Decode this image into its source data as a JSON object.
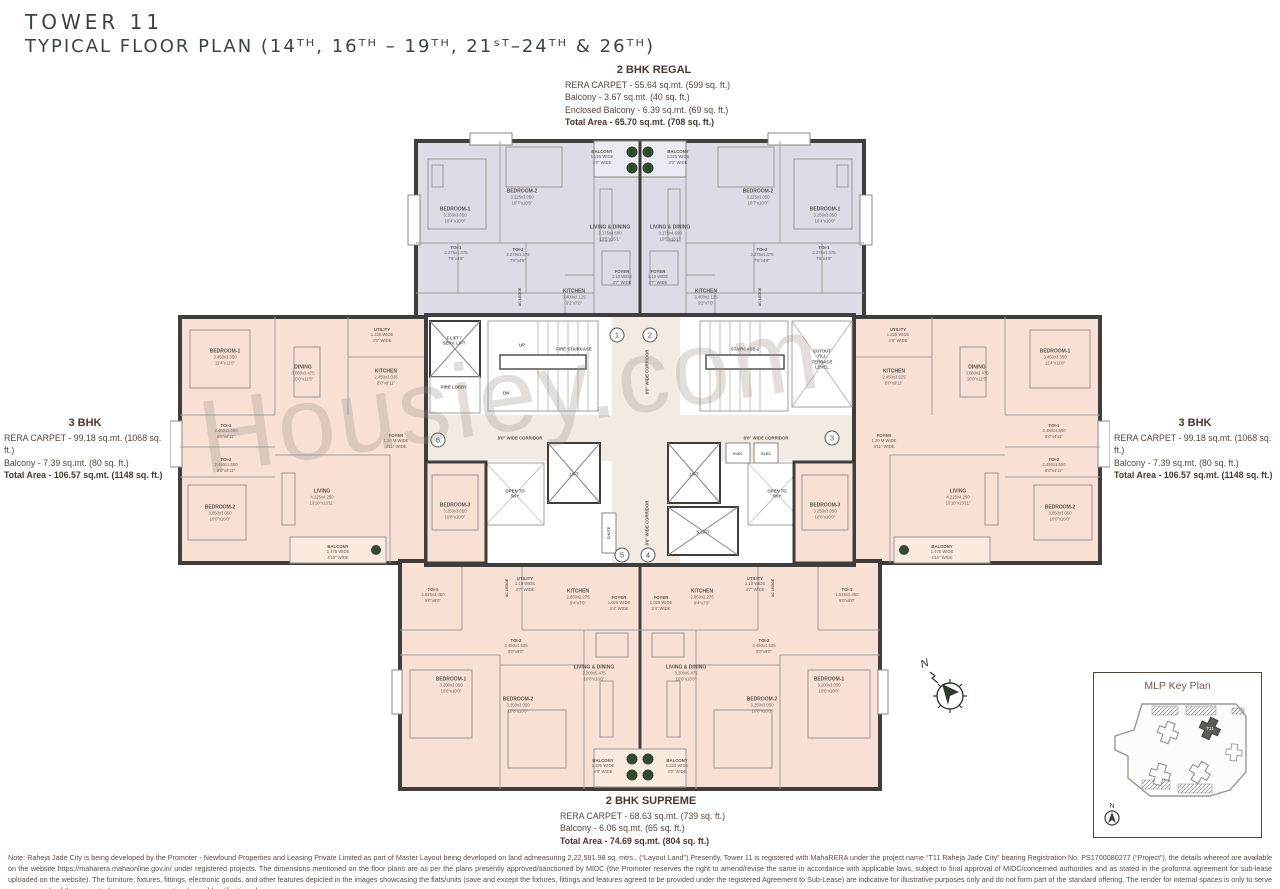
{
  "page": {
    "title_line1": "TOWER 11",
    "title_line2": "TYPICAL FLOOR PLAN (14ᵀᴴ, 16ᵀᴴ – 19ᵀᴴ, 21ˢᵀ–24ᵀᴴ & 26ᵀᴴ)"
  },
  "units": {
    "regal": {
      "name": "2 BHK REGAL",
      "line1": "RERA CARPET - 55.64 sq.mt. (599 sq. ft.)",
      "line2": "Balcony  - 3.67 sq.mt. (40 sq. ft.)",
      "line3": "Enclosed Balcony  - 6.39 sq.mt. (69 sq. ft.)",
      "total": "Total Area - 65.70 sq.mt. (708 sq. ft.)"
    },
    "bhk3_left": {
      "name": "3 BHK",
      "line1": "RERA CARPET - 99.18 sq.mt. (1068 sq. ft.)",
      "line2": "Balcony  - 7.39 sq.mt. (80 sq. ft.)",
      "total": "Total Area - 106.57 sq.mt. (1148 sq. ft.)"
    },
    "bhk3_right": {
      "name": "3 BHK",
      "line1": "RERA CARPET - 99.18 sq.mt. (1068 sq. ft.)",
      "line2": "Balcony  - 7.39 sq.mt. (80 sq. ft.)",
      "total": "Total Area - 106.57 sq.mt. (1148 sq. ft.)"
    },
    "supreme": {
      "name": "2 BHK SUPREME",
      "line1": "RERA CARPET - 68.63 sq.mt. (739 sq. ft.)",
      "line2": "Balcony  - 6.06 sq.mt. (65 sq. ft.)",
      "total": "Total Area - 74.69 sq.mt. (804 sq. ft.)"
    }
  },
  "watermark": "Housiey.com",
  "compass_label": "N",
  "key_plan": {
    "title": "MLP Key Plan",
    "highlight_tower": "T11",
    "compass": "N"
  },
  "note": "Note: Raheja Jade City is being developed by the Promoter - Newfound Properties and Leasing Private Limited as part of Master Layout being developed on land admeasuring 2,22,591.98 sq. mtrs.. (“Layout Land”) Presently, Tower 11 is registered with MahaRERA under the project name “T11 Raheja Jade City” bearing Registration No. PS1700080277 (“Project”), the details whereof are available on the website https://maharera.mahaonline.gov.in/ under registered projects. The dimensions mentioned on the floor plans are as per the plans presently approved/sanctioned by MIDC (the Promoter reserves the right to amend/revise the same in accordance with applicable laws, subject to final approval of MIDC/concerned authorities and as stated in the proforma agreement for sub-lease uploaded on the website). The furniture, fixtures, fittings, electronic goods, and other features depicted in the images showcasing the flats/units (save and except the fixtures, fittings and features agreed to be provided under the registered Agreement to Sub-Lease) are indicative for illustrative purposes only and do not form part of the standard offering. The render for internal spaces is only to serve as an example of the suggested space management and possible utilization of space.",
  "colors": {
    "wall": "#403e3b",
    "regal_fill": "#dcdbe6",
    "bhk_fill": "#f9e0d5",
    "corridor_fill": "#f2ebe4",
    "plant_green": "#2f4a2f",
    "heading_text": "#4a382e",
    "title_text": "#3c443e"
  },
  "floor_plan": {
    "circled_numbers": [
      {
        "n": "1",
        "x": 447,
        "y": 210
      },
      {
        "n": "2",
        "x": 480,
        "y": 210
      },
      {
        "n": "3",
        "x": 662,
        "y": 313
      },
      {
        "n": "4",
        "x": 478,
        "y": 430
      },
      {
        "n": "5",
        "x": 452,
        "y": 430
      },
      {
        "n": "6",
        "x": 268,
        "y": 315
      }
    ],
    "labels": [
      {
        "t": "BALCONY",
        "d": "1.225 WIDE\n4'0\" WIDE",
        "x": 432,
        "y": 32,
        "s": "xs"
      },
      {
        "t": "BALCONY",
        "d": "1.225 WIDE\n4'0\" WIDE",
        "x": 508,
        "y": 32,
        "s": "xs"
      },
      {
        "t": "BEDROOM-1",
        "d": "3.150x3.050\n10'4\"x10'0\"",
        "x": 285,
        "y": 90
      },
      {
        "t": "BEDROOM-2",
        "d": "3.225x3.050\n10'7\"x10'0\"",
        "x": 352,
        "y": 72
      },
      {
        "t": "LIVING & DINING",
        "d": "3.175x4.600\n10'5\"x15'1\"",
        "x": 440,
        "y": 108
      },
      {
        "t": "TOI-1",
        "d": "2.275x1.375\n7'6\"x4'6\"",
        "x": 286,
        "y": 128,
        "s": "xs"
      },
      {
        "t": "TOI-2",
        "d": "2.275x1.375\n7'6\"x4'6\"",
        "x": 348,
        "y": 130,
        "s": "xs"
      },
      {
        "t": "KITCHEN",
        "d": "3.400x2.125\n9'2\"x7'0\"",
        "x": 404,
        "y": 172
      },
      {
        "t": "FOYER",
        "d": "1.10 WIDE\n3'7\" WIDE",
        "x": 452,
        "y": 152,
        "s": "xs"
      },
      {
        "t": "AC LEDGE",
        "x": 350,
        "y": 172,
        "r": -90,
        "s": "xxs"
      },
      {
        "t": "BEDROOM-1",
        "d": "3.150x3.050\n10'4\"x10'0\"",
        "x": 655,
        "y": 90
      },
      {
        "t": "BEDROOM-2",
        "d": "3.225x3.050\n10'7\"x10'0\"",
        "x": 588,
        "y": 72
      },
      {
        "t": "LIVING & DINING",
        "d": "3.175x4.600\n10'5\"x15'1\"",
        "x": 500,
        "y": 108
      },
      {
        "t": "TOI-1",
        "d": "2.275x1.375\n7'6\"x4'6\"",
        "x": 654,
        "y": 128,
        "s": "xs"
      },
      {
        "t": "TOI-2",
        "d": "2.275x1.375\n7'6\"x4'6\"",
        "x": 592,
        "y": 130,
        "s": "xs"
      },
      {
        "t": "KITCHEN",
        "d": "3.400x2.125\n9'2\"x7'0\"",
        "x": 536,
        "y": 172
      },
      {
        "t": "FOYER",
        "d": "1.10 WIDE\n3'7\" WIDE",
        "x": 488,
        "y": 152,
        "s": "xs"
      },
      {
        "t": "AC LEDGE",
        "x": 590,
        "y": 172,
        "r": -90,
        "s": "xxs"
      },
      {
        "t": "F.LIFT /\nSERV. LIFT",
        "x": 284,
        "y": 216,
        "s": "xs"
      },
      {
        "t": "FIRE LOBBY",
        "x": 284,
        "y": 262,
        "s": "xs"
      },
      {
        "t": "UP",
        "x": 352,
        "y": 220,
        "s": "xs"
      },
      {
        "t": "DN",
        "x": 336,
        "y": 268,
        "s": "xs"
      },
      {
        "t": "FIRE STAIRCASE",
        "x": 404,
        "y": 224,
        "s": "xs"
      },
      {
        "t": "STAIRCASE-2",
        "x": 575,
        "y": 224,
        "s": "xs"
      },
      {
        "t": "CUTOUT\nTILL\nTERRACE\nLEVEL",
        "x": 652,
        "y": 234,
        "s": "xs"
      },
      {
        "t": "LIFT",
        "x": 404,
        "y": 349,
        "s": "xs"
      },
      {
        "t": "LIFT",
        "x": 524,
        "y": 349,
        "s": "xs"
      },
      {
        "t": "S.LIFT",
        "x": 533,
        "y": 407,
        "s": "xs"
      },
      {
        "t": "OPEN TO\nSKY",
        "x": 345,
        "y": 369,
        "s": "xs"
      },
      {
        "t": "OPEN TO\nSKY",
        "x": 607,
        "y": 369,
        "s": "xs"
      },
      {
        "t": "ELEC",
        "x": 568,
        "y": 329,
        "s": "xxs"
      },
      {
        "t": "ELEC",
        "x": 596,
        "y": 329,
        "s": "xxs"
      },
      {
        "t": "CHUTE",
        "x": 439,
        "y": 408,
        "r": -90,
        "s": "xxs"
      },
      {
        "t": "8'0\" WIDE CORRIDOR",
        "x": 477,
        "y": 247,
        "r": -90,
        "s": "xs"
      },
      {
        "t": "8'0\" WIDE CORRIDOR",
        "x": 477,
        "y": 398,
        "r": -90,
        "s": "xs"
      },
      {
        "t": "8'0\" WIDE CORRIDOR",
        "x": 350,
        "y": 313,
        "s": "xs"
      },
      {
        "t": "8'0\" WIDE CORRIDOR",
        "x": 596,
        "y": 313,
        "s": "xs"
      },
      {
        "t": "BEDROOM-1",
        "d": "3.450x3.350\n11'4\"x11'0\"",
        "x": 55,
        "y": 232
      },
      {
        "t": "DINING",
        "d": "3.060x3.475\n10'0\"x11'5\"",
        "x": 133,
        "y": 248
      },
      {
        "t": "KITCHEN",
        "d": "2.450x3.025\n8'0\"x9'11\"",
        "x": 216,
        "y": 252
      },
      {
        "t": "UTILITY",
        "d": "1.225 WIDE\n4'0\" WIDE",
        "x": 212,
        "y": 210,
        "s": "xs"
      },
      {
        "t": "TOI-1",
        "d": "2.450x1.500\n8'0\"x4'11\"",
        "x": 56,
        "y": 306,
        "s": "xs"
      },
      {
        "t": "TOI-2",
        "d": "2.450x1.500\n8'0\"x4'11\"",
        "x": 56,
        "y": 340,
        "s": "xs"
      },
      {
        "t": "BEDROOM-2",
        "d": "3.050x3.050\n10'0\"x10'0\"",
        "x": 50,
        "y": 388
      },
      {
        "t": "LIVING",
        "d": "4.225x4.250\n13'10\"x13'11\"",
        "x": 152,
        "y": 372
      },
      {
        "t": "FOYER",
        "d": "1.20 M WIDE\n3'11\" WIDE",
        "x": 226,
        "y": 316,
        "s": "xs"
      },
      {
        "t": "BEDROOM-3",
        "d": "3.250x3.050\n10'8\"x10'0\"",
        "x": 285,
        "y": 386
      },
      {
        "t": "BALCONY",
        "d": "1.475 WIDE\n4'10\" WIDE",
        "x": 168,
        "y": 427,
        "s": "xs"
      },
      {
        "t": "BEDROOM-1",
        "d": "3.450x3.350\n11'4\"x11'0\"",
        "x": 885,
        "y": 232
      },
      {
        "t": "DINING",
        "d": "3.060x3.475\n10'0\"x11'5\"",
        "x": 807,
        "y": 248
      },
      {
        "t": "KITCHEN",
        "d": "2.450x3.025\n8'0\"x9'11\"",
        "x": 724,
        "y": 252
      },
      {
        "t": "UTILITY",
        "d": "1.225 WIDE\n4'0\" WIDE",
        "x": 728,
        "y": 210,
        "s": "xs"
      },
      {
        "t": "TOI-1",
        "d": "2.450x1.500\n8'0\"x4'11\"",
        "x": 884,
        "y": 306,
        "s": "xs"
      },
      {
        "t": "TOI-2",
        "d": "2.450x1.500\n8'0\"x4'11\"",
        "x": 884,
        "y": 340,
        "s": "xs"
      },
      {
        "t": "BEDROOM-2",
        "d": "3.050x3.050\n10'0\"x10'0\"",
        "x": 890,
        "y": 388
      },
      {
        "t": "LIVING",
        "d": "4.225x4.250\n13'10\"x13'11\"",
        "x": 788,
        "y": 372
      },
      {
        "t": "FOYER",
        "d": "1.20 M WIDE\n3'11\" WIDE",
        "x": 714,
        "y": 316,
        "s": "xs"
      },
      {
        "t": "BEDROOM-3",
        "d": "3.250x3.050\n10'8\"x10'0\"",
        "x": 655,
        "y": 386
      },
      {
        "t": "BALCONY",
        "d": "1.475 WIDE\n4'10\" WIDE",
        "x": 772,
        "y": 427,
        "s": "xs"
      },
      {
        "t": "UTILITY",
        "d": "1.10 WIDE\n3'7\" WIDE",
        "x": 355,
        "y": 459,
        "s": "xs"
      },
      {
        "t": "KITCHEN",
        "d": "2.850x2.275\n9'4\"x7'5\"",
        "x": 408,
        "y": 472
      },
      {
        "t": "FOYER",
        "d": "1.025 WIDE\n3'4\" WIDE",
        "x": 449,
        "y": 478,
        "s": "xs"
      },
      {
        "t": "TOI-1",
        "d": "1.525x2.450\n5'0\"x8'0\"",
        "x": 263,
        "y": 470,
        "s": "xs"
      },
      {
        "t": "TOI-2",
        "d": "2.450x1.525\n8'0\"x5'0\"",
        "x": 346,
        "y": 521,
        "s": "xs"
      },
      {
        "t": "BEDROOM-1",
        "d": "3.200x3.050\n10'6\"x10'0\"",
        "x": 281,
        "y": 560
      },
      {
        "t": "BEDROOM-2",
        "d": "3.250x3.050\n10'8\"x10'0\"",
        "x": 348,
        "y": 580
      },
      {
        "t": "LIVING & DINING",
        "d": "3.200x5.475\n10'6\"x18'0\"",
        "x": 424,
        "y": 548
      },
      {
        "t": "BALCONY",
        "d": "1.225 WIDE\n4'0\" WIDE",
        "x": 433,
        "y": 641,
        "s": "xs"
      },
      {
        "t": "AC LEDGE",
        "x": 337,
        "y": 463,
        "r": -90,
        "s": "xxs"
      },
      {
        "t": "UTILITY",
        "d": "1.10 WIDE\n3'7\" WIDE",
        "x": 585,
        "y": 459,
        "s": "xs"
      },
      {
        "t": "KITCHEN",
        "d": "2.850x2.275\n9'4\"x7'5\"",
        "x": 532,
        "y": 472
      },
      {
        "t": "FOYER",
        "d": "1.025 WIDE\n3'4\" WIDE",
        "x": 491,
        "y": 478,
        "s": "xs"
      },
      {
        "t": "TOI-1",
        "d": "1.525x2.450\n5'0\"x8'0\"",
        "x": 677,
        "y": 470,
        "s": "xs"
      },
      {
        "t": "TOI-2",
        "d": "2.450x1.525\n8'0\"x5'0\"",
        "x": 594,
        "y": 521,
        "s": "xs"
      },
      {
        "t": "BEDROOM-1",
        "d": "3.200x3.050\n10'6\"x10'0\"",
        "x": 659,
        "y": 560
      },
      {
        "t": "BEDROOM-2",
        "d": "3.250x3.050\n10'8\"x10'0\"",
        "x": 592,
        "y": 580
      },
      {
        "t": "LIVING & DINING",
        "d": "3.200x5.475\n10'6\"x18'0\"",
        "x": 516,
        "y": 548
      },
      {
        "t": "BALCONY",
        "d": "1.225 WIDE\n4'0\" WIDE",
        "x": 507,
        "y": 641,
        "s": "xs"
      },
      {
        "t": "AC LEDGE",
        "x": 603,
        "y": 463,
        "r": -90,
        "s": "xxs"
      }
    ]
  }
}
